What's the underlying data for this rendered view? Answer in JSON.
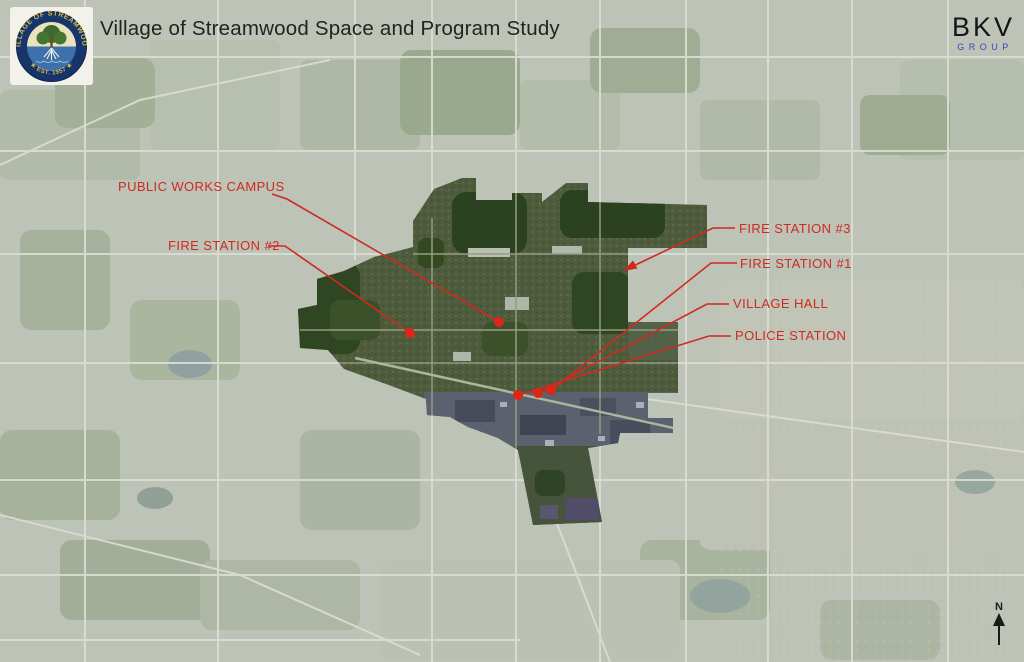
{
  "slide": {
    "title": "Village of Streamwood Space and Program Study"
  },
  "brand": {
    "name": "BKV",
    "sub": "GROUP"
  },
  "logo": {
    "arc_top": "VILLAGE OF STREAMWOOD",
    "arc_bottom": "★ EST. 1957 ★"
  },
  "map": {
    "type": "aerial-photo study map with highlighted village boundary",
    "labels": {
      "public_works": "PUBLIC WORKS CAMPUS",
      "fire_station_2": "FIRE STATION #2",
      "fire_station_3": "FIRE STATION #3",
      "fire_station_1": "FIRE STATION #1",
      "village_hall": "VILLAGE HALL",
      "police_station": "POLICE STATION"
    },
    "north_label": "N",
    "colors": {
      "annotation_red": "#cf2a21",
      "marker_red": "#e02417",
      "title_ink": "#23231f",
      "brand_blue": "#3c45c0",
      "faded_map": "#bdc3b6",
      "village_green": "#4e5c3d"
    }
  }
}
